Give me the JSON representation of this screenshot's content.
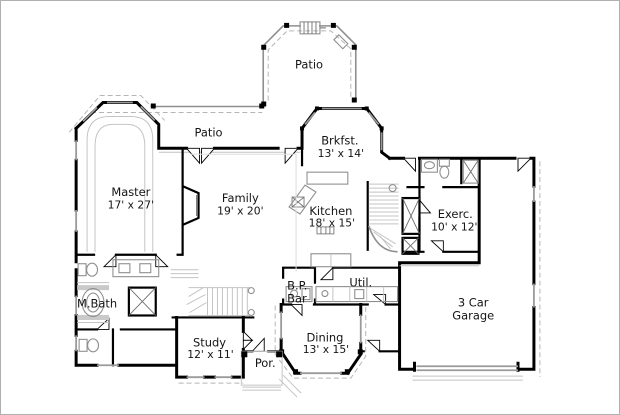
{
  "document": {
    "type": "architectural-floor-plan",
    "colors": {
      "background": "#ffffff",
      "border": "#b0b0b0",
      "walls": "#000000",
      "thin_lines": "#8f8f8f",
      "light_lines": "#c4c4c4",
      "dashed_lines": "#b5b5b5",
      "text": "#141414"
    }
  },
  "rooms": {
    "patio_top": {
      "name": "Patio"
    },
    "patio_back": {
      "name": "Patio"
    },
    "brkfst": {
      "name": "Brkfst.",
      "dims": "13' x 14'"
    },
    "master": {
      "name": "Master",
      "dims": "17' x 27'"
    },
    "family": {
      "name": "Family",
      "dims": "19' x 20'"
    },
    "kitchen": {
      "name": "Kitchen",
      "dims": "18' x 15'"
    },
    "exercise": {
      "name": "Exerc.",
      "dims": "10' x 12'"
    },
    "master_bath": {
      "name": "M.Bath"
    },
    "butlers_pantry": {
      "line1": "B.P.",
      "line2": "Bar"
    },
    "utility": {
      "name": "Util."
    },
    "garage": {
      "line1": "3 Car",
      "line2": "Garage"
    },
    "study": {
      "name": "Study",
      "dims": "12' x 11'"
    },
    "porch": {
      "name": "Por."
    },
    "dining": {
      "name": "Dining",
      "dims": "13' x 15'"
    }
  },
  "icons": {
    "grill-icon": "hatched rectangle on top patio wall",
    "patio-door-icon": "angled rectangle on patio corner",
    "door-icon": "triangular swing wedge",
    "window-icon": "gray wall segment",
    "tub-icon": "oval tub in hatched alcove",
    "shower-icon": "box with X",
    "toilet-icon": "tank with bowl ellipse",
    "vanity-icon": "counter with two sink boxes",
    "kitchen-sink-icon": "box with X on angled counter",
    "cooktop-icon": "small marked rectangle",
    "bar-sink-icon": "circle on counter",
    "laundry-counter-icon": "segmented counter",
    "fireplace-icon": "angled firebox",
    "stairs-icon": "parallel tread lines with newel circles",
    "closet-icon": "box with X",
    "garage-door-icon": "double thin lines in wall opening"
  }
}
